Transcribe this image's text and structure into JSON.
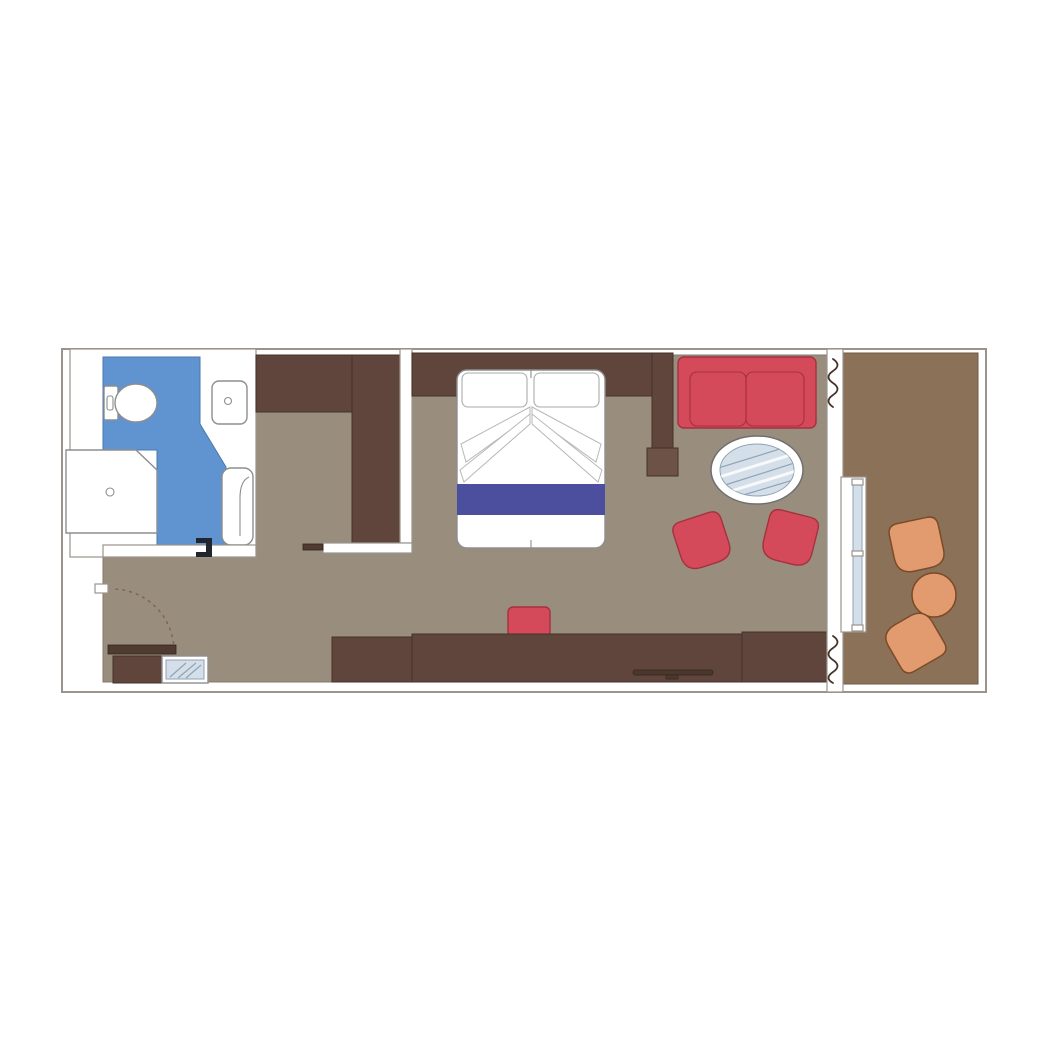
{
  "canvas": {
    "width": 1042,
    "height": 1042,
    "background": "#ffffff"
  },
  "palette": {
    "wall": "#ffffff",
    "outline": "#9a948c",
    "floor": "#998e7e",
    "balcony_floor": "#8a7157",
    "wood": "#5f453b",
    "wood_stroke": "#443128",
    "wood_light": "#6d5347",
    "door_leaf": "#503b31",
    "bathroom_blue": "#6094d0",
    "bed_runner": "#4c4f9e",
    "red": "#d54a5b",
    "red_stroke": "#a5313f",
    "orange": "#e19b6f",
    "orange_stroke": "#7d4a28",
    "glass": "#d5dfe9",
    "glass_stroke": "#8fa3b5",
    "fixture_stroke": "#8e8e8e",
    "curtain": "#463329",
    "handle_dark": "#20262b"
  },
  "rooms": [
    {
      "name": "bathroom"
    },
    {
      "name": "dressing-area"
    },
    {
      "name": "bedroom"
    },
    {
      "name": "sitting-area"
    },
    {
      "name": "entry"
    },
    {
      "name": "balcony"
    }
  ],
  "furniture": [
    {
      "name": "toilet"
    },
    {
      "name": "washbasin"
    },
    {
      "name": "shower"
    },
    {
      "name": "bathtub"
    },
    {
      "name": "wardrobe"
    },
    {
      "name": "double-bed"
    },
    {
      "name": "pillows"
    },
    {
      "name": "bed-runner"
    },
    {
      "name": "stool"
    },
    {
      "name": "desk-cabinet"
    },
    {
      "name": "tv"
    },
    {
      "name": "sofa"
    },
    {
      "name": "round-glass-table"
    },
    {
      "name": "armchair"
    },
    {
      "name": "armchair"
    },
    {
      "name": "balcony-chair"
    },
    {
      "name": "balcony-table"
    },
    {
      "name": "balcony-chair"
    },
    {
      "name": "entry-door"
    },
    {
      "name": "entry-cabinet"
    },
    {
      "name": "luggage-glass-shelf"
    },
    {
      "name": "sliding-glass-door"
    },
    {
      "name": "curtains"
    }
  ]
}
